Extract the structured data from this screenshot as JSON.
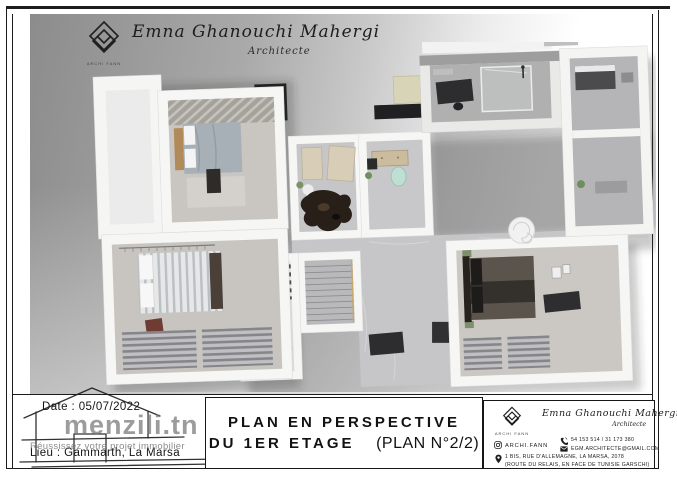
{
  "header": {
    "brand_name": "Emna Ghanouchi Mahergi",
    "brand_title": "Architecte",
    "logo_caption": "ARCHI FANN"
  },
  "plan_meta": {
    "date_label": "Date :",
    "date_value": "05/07/2022",
    "place_label": "Lieu :",
    "place_value": "Gammarth, La Marsa"
  },
  "watermark": {
    "site": "menzili.tn",
    "tagline": "Réussissez votre projet immobilier"
  },
  "title_block": {
    "line1": "PLAN EN PERSPECTIVE",
    "line2": "DU 1ER ETAGE",
    "line2_suffix": "(PLAN N°2/2)"
  },
  "business_card": {
    "brand_name": "Emna Ghanouchi Mahergi",
    "brand_title": "Architecte",
    "logo_caption": "ARCHI FANN",
    "instagram_handle": "ARCHI.FANN",
    "phone": "54 153 514 / 31 173 380",
    "email": "EGM.ARCHITECTE@GMAIL.COM",
    "address_line1": "1 BIS, RUE D'ALLEMAGNE, LA MARSA, 2078",
    "address_line2": "(ROUTE DU RELAIS, EN FACE DE TUNISIE GARSCHI)"
  },
  "colors": {
    "frame": "#1c1c1c",
    "backdrop_gray": "#8c8c8c",
    "wall_white": "#f5f5f4",
    "floor_gray": "#c7c7c9",
    "roof_black": "#202023",
    "accent_mint": "#bfdfd3",
    "sofa_beige": "#d8cdb6",
    "watermark_gray": "#767676"
  }
}
